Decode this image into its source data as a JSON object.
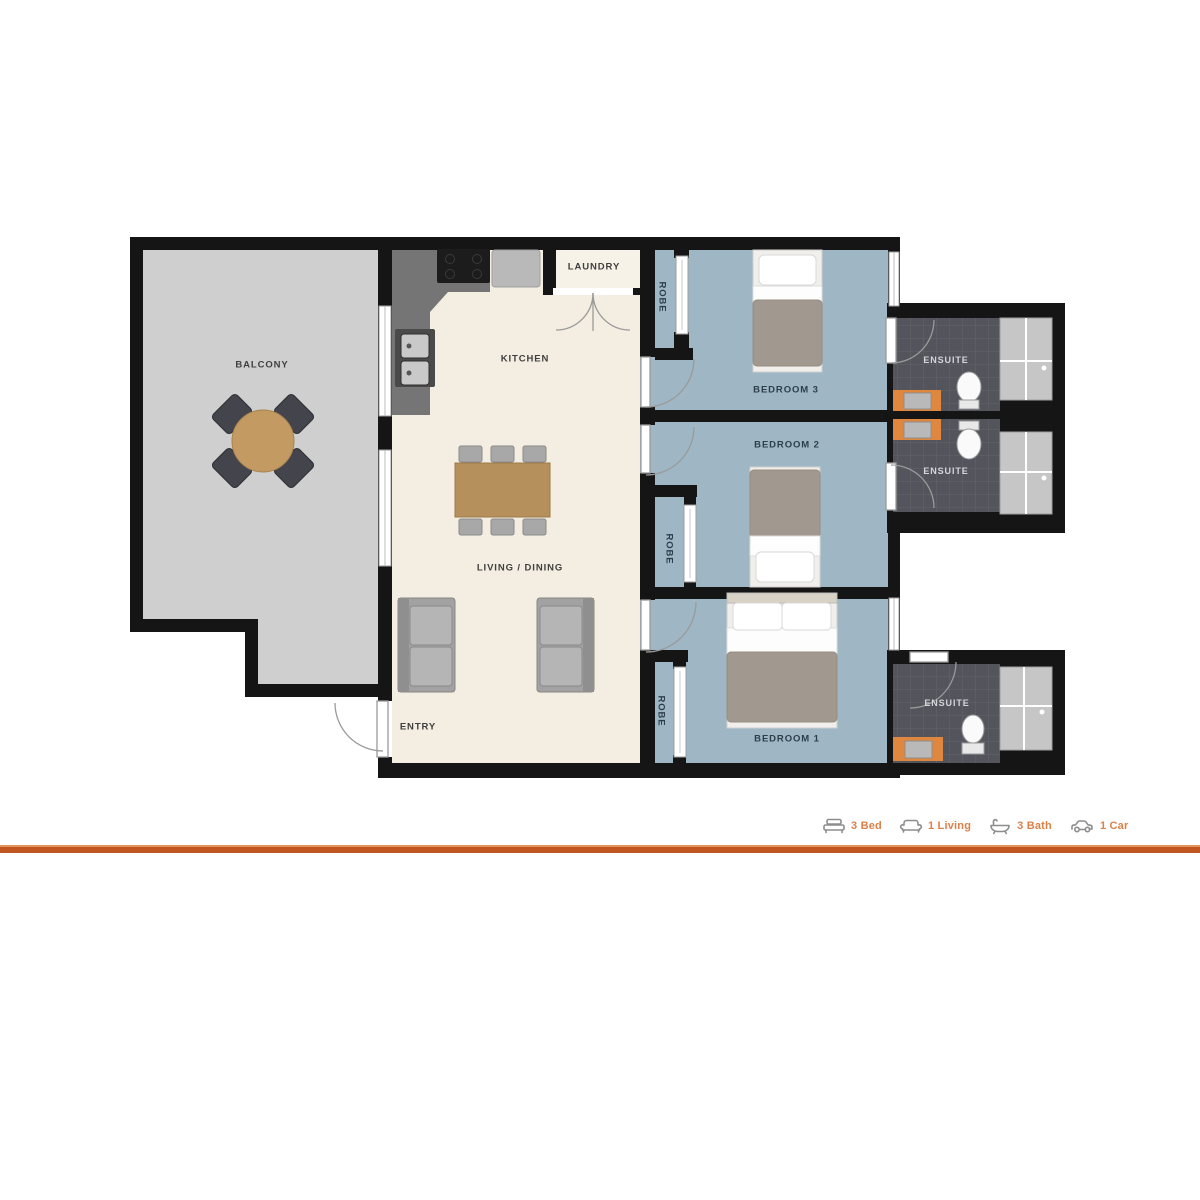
{
  "plan": {
    "labels": {
      "balcony": "BALCONY",
      "kitchen": "KITCHEN",
      "laundry": "LAUNDRY",
      "living_dining": "LIVING / DINING",
      "entry": "ENTRY",
      "bedroom3": "BEDROOM 3",
      "bedroom2": "BEDROOM 2",
      "bedroom1": "BEDROOM 1",
      "robe": "ROBE",
      "ensuite": "ENSUITE"
    }
  },
  "legend": {
    "items": [
      {
        "icon": "bed-icon",
        "label": "3 Bed"
      },
      {
        "icon": "sofa-icon",
        "label": "1 Living"
      },
      {
        "icon": "bath-icon",
        "label": "3 Bath"
      },
      {
        "icon": "car-icon",
        "label": "1 Car"
      }
    ]
  },
  "colors": {
    "wall": "#151515",
    "balcony_floor": "#cfcfcf",
    "living_floor": "#f3eee1",
    "bedroom_floor": "#9fb7c4",
    "ensuite_floor": "#54545c",
    "shower": "#c6c6c6",
    "vanity_orange": "#e0873f",
    "legend_text_orange": "#dd8048",
    "rule_orange": "#c05722"
  }
}
